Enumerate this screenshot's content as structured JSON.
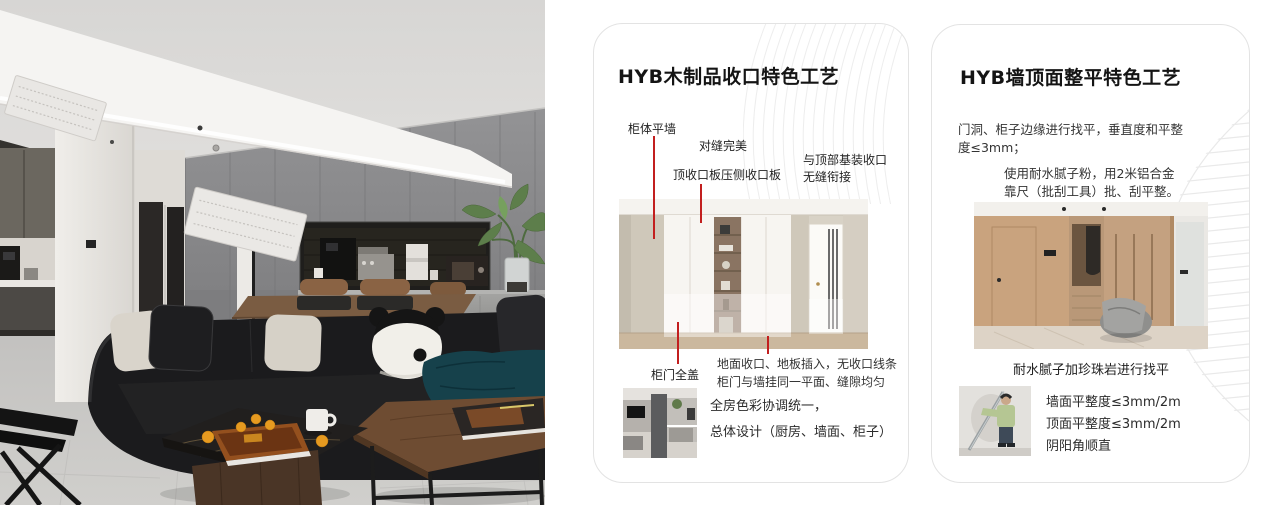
{
  "colors": {
    "accent_red": "#c21f1f",
    "card_border": "#e3e3e3"
  },
  "card1": {
    "title": "HYB木制品收口特色工艺",
    "callout_cabinet_wall": "柜体平墙",
    "callout_seam": "对缝完美",
    "callout_top_panel": "顶收口板压侧收口板",
    "callout_top_joint_1": "与顶部基装收口",
    "callout_top_joint_2": "无缝衔接",
    "callout_door_cover": "柜门全盖",
    "note_floor_1": "地面收口、地板插入，无收口线条",
    "note_floor_2": "柜门与墙挂同一平面、缝隙均匀",
    "note_color_1": "全房色彩协调统一，",
    "note_color_2": "总体设计（厨房、墙面、柜子）"
  },
  "card2": {
    "title": "HYB墙顶面整平特色工艺",
    "para1_1": "门洞、柜子边缘进行找平，垂直度和平整",
    "para1_2": "度≤3mm；",
    "para2_1": "使用耐水腻子粉，用2米铝合金",
    "para2_2": "靠尺（批刮工具）批、刮平整。",
    "caption": "耐水腻子加珍珠岩进行找平",
    "specs": [
      "墙面平整度≤3mm/2m",
      "顶面平整度≤3mm/2m",
      "阴阳角顺直"
    ]
  }
}
